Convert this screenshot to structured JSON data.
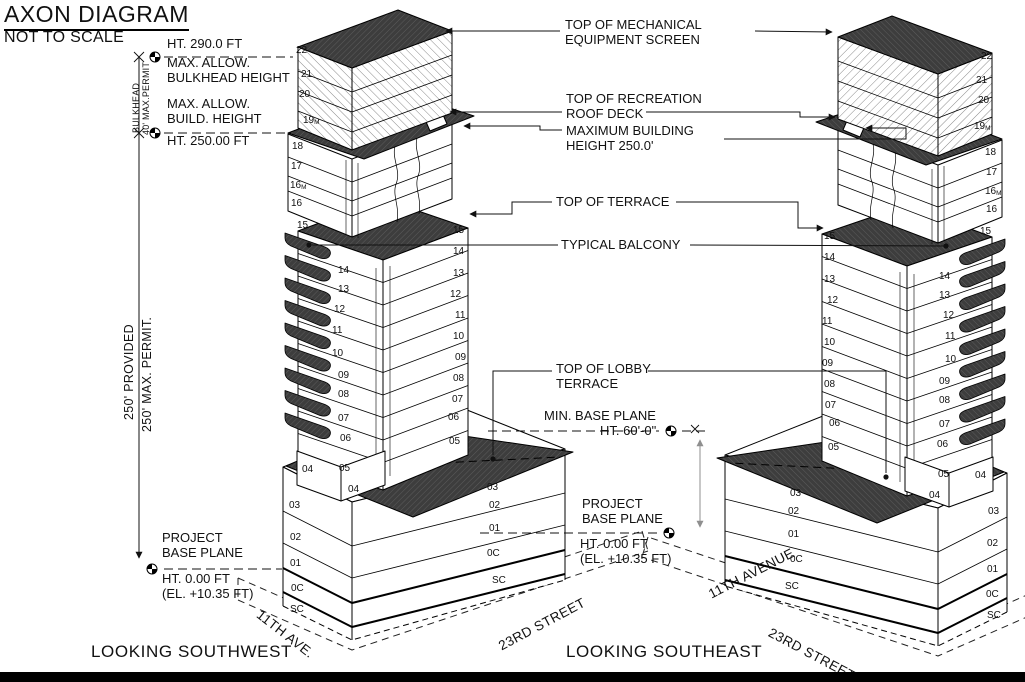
{
  "title": "AXON DIAGRAM",
  "subtitle": "NOT TO SCALE",
  "captions": {
    "southwest": "LOOKING SOUTHWEST",
    "southeast": "LOOKING SOUTHEAST"
  },
  "streets": {
    "ave_left": "11TH AVE.",
    "st_left": "23RD STREET",
    "ave_right": "11TH AVENUE",
    "st_right": "23RD STREET"
  },
  "dims": {
    "bulkhead": "BULKHEAD",
    "bulkhead_permit": "40' MAX.PERMIT",
    "provided": "250' PROVIDED",
    "max_permit": "250' MAX. PERMIT.",
    "ht_290": "HT. 290.0 FT",
    "max_allow_1": "MAX. ALLOW.",
    "bulkhead_height": "BULKHEAD HEIGHT",
    "max_allow_2": "MAX. ALLOW.",
    "build_height": "BUILD. HEIGHT",
    "ht_250": "HT. 250.00 FT"
  },
  "annotations": {
    "mech_1": "TOP OF MECHANICAL",
    "mech_2": "EQUIPMENT SCREEN",
    "rec_1": "TOP OF RECREATION",
    "rec_2": "ROOF DECK",
    "maxb_1": "MAXIMUM BUILDING",
    "maxb_2": "HEIGHT 250.0'",
    "terrace": "TOP OF TERRACE",
    "balcony": "TYPICAL BALCONY",
    "lobby_1": "TOP OF LOBBY",
    "lobby_2": "TERRACE",
    "minbase_1": "MIN. BASE PLANE",
    "minbase_2": "HT. 60'-0\"",
    "pbp_1": "PROJECT",
    "pbp_2": "BASE PLANE",
    "pbp_ht": "HT. 0.00 FT",
    "pbp_el": "(EL. +10.35 FT)",
    "pbp_left_1": "PROJECT",
    "pbp_left_2": "BASE PLANE",
    "pbp_left_ht": "HT. 0.00 FT",
    "pbp_left_el": "(EL. +10.35 FT)"
  },
  "colors": {
    "paper": "#ffffff",
    "ink": "#111111",
    "dark_fill": "#3d3d3d",
    "dim_gray": "#8f8f8f"
  },
  "floor_labels": {
    "left": [
      {
        "t": "22",
        "x": 296,
        "y": 53
      },
      {
        "t": "21",
        "x": 301,
        "y": 77
      },
      {
        "t": "20",
        "x": 299,
        "y": 97
      },
      {
        "t": "19",
        "s": "M",
        "x": 303,
        "y": 123
      },
      {
        "t": "18",
        "x": 292,
        "y": 149
      },
      {
        "t": "17",
        "x": 291,
        "y": 169
      },
      {
        "t": "16",
        "s": "M",
        "x": 290,
        "y": 188
      },
      {
        "t": "16",
        "x": 291,
        "y": 206
      },
      {
        "t": "15",
        "x": 297,
        "y": 228
      },
      {
        "t": "14",
        "x": 338,
        "y": 273
      },
      {
        "t": "13",
        "x": 338,
        "y": 292
      },
      {
        "t": "12",
        "x": 334,
        "y": 312
      },
      {
        "t": "11",
        "x": 332,
        "y": 333
      },
      {
        "t": "10",
        "x": 332,
        "y": 356
      },
      {
        "t": "09",
        "x": 338,
        "y": 378
      },
      {
        "t": "08",
        "x": 338,
        "y": 397
      },
      {
        "t": "07",
        "x": 338,
        "y": 421
      },
      {
        "t": "06",
        "x": 340,
        "y": 441
      },
      {
        "t": "05",
        "x": 339,
        "y": 471
      },
      {
        "t": "04",
        "x": 302,
        "y": 472
      },
      {
        "t": "15",
        "x": 453,
        "y": 233
      },
      {
        "t": "14",
        "x": 453,
        "y": 254
      },
      {
        "t": "13",
        "x": 453,
        "y": 276
      },
      {
        "t": "12",
        "x": 450,
        "y": 297
      },
      {
        "t": "11",
        "x": 455,
        "y": 318
      },
      {
        "t": "10",
        "x": 453,
        "y": 339
      },
      {
        "t": "09",
        "x": 455,
        "y": 360
      },
      {
        "t": "08",
        "x": 453,
        "y": 381
      },
      {
        "t": "07",
        "x": 452,
        "y": 402
      },
      {
        "t": "06",
        "x": 448,
        "y": 420
      },
      {
        "t": "05",
        "x": 449,
        "y": 444
      },
      {
        "t": "04",
        "x": 348,
        "y": 492
      },
      {
        "t": "03",
        "x": 289,
        "y": 508
      },
      {
        "t": "02",
        "x": 290,
        "y": 540
      },
      {
        "t": "01",
        "x": 290,
        "y": 566
      },
      {
        "t": "0C",
        "x": 291,
        "y": 591
      },
      {
        "t": "SC",
        "x": 290,
        "y": 612
      },
      {
        "t": "03",
        "x": 487,
        "y": 490
      },
      {
        "t": "02",
        "x": 489,
        "y": 508
      },
      {
        "t": "01",
        "x": 489,
        "y": 531
      },
      {
        "t": "0C",
        "x": 487,
        "y": 556
      },
      {
        "t": "SC",
        "x": 492,
        "y": 583
      }
    ],
    "right": [
      {
        "t": "22",
        "x": 981,
        "y": 59
      },
      {
        "t": "21",
        "x": 976,
        "y": 83
      },
      {
        "t": "20",
        "x": 978,
        "y": 103
      },
      {
        "t": "19",
        "s": "M",
        "x": 974,
        "y": 129
      },
      {
        "t": "18",
        "x": 985,
        "y": 155
      },
      {
        "t": "17",
        "x": 986,
        "y": 175
      },
      {
        "t": "16",
        "s": "M",
        "x": 985,
        "y": 194
      },
      {
        "t": "16",
        "x": 986,
        "y": 212
      },
      {
        "t": "15",
        "x": 980,
        "y": 234
      },
      {
        "t": "15",
        "x": 824,
        "y": 239
      },
      {
        "t": "14",
        "x": 824,
        "y": 260
      },
      {
        "t": "13",
        "x": 824,
        "y": 282
      },
      {
        "t": "12",
        "x": 827,
        "y": 303
      },
      {
        "t": "11",
        "x": 822,
        "y": 324
      },
      {
        "t": "10",
        "x": 824,
        "y": 345
      },
      {
        "t": "09",
        "x": 822,
        "y": 366
      },
      {
        "t": "08",
        "x": 824,
        "y": 387
      },
      {
        "t": "07",
        "x": 825,
        "y": 408
      },
      {
        "t": "06",
        "x": 829,
        "y": 426
      },
      {
        "t": "05",
        "x": 828,
        "y": 450
      },
      {
        "t": "14",
        "x": 939,
        "y": 279
      },
      {
        "t": "13",
        "x": 939,
        "y": 298
      },
      {
        "t": "12",
        "x": 943,
        "y": 318
      },
      {
        "t": "11",
        "x": 945,
        "y": 339
      },
      {
        "t": "10",
        "x": 945,
        "y": 362
      },
      {
        "t": "09",
        "x": 939,
        "y": 384
      },
      {
        "t": "08",
        "x": 939,
        "y": 403
      },
      {
        "t": "07",
        "x": 939,
        "y": 427
      },
      {
        "t": "06",
        "x": 937,
        "y": 447
      },
      {
        "t": "05",
        "x": 938,
        "y": 477
      },
      {
        "t": "04",
        "x": 975,
        "y": 478
      },
      {
        "t": "04",
        "x": 929,
        "y": 498
      },
      {
        "t": "03",
        "x": 988,
        "y": 514
      },
      {
        "t": "02",
        "x": 987,
        "y": 546
      },
      {
        "t": "01",
        "x": 987,
        "y": 572
      },
      {
        "t": "0C",
        "x": 986,
        "y": 597
      },
      {
        "t": "SC",
        "x": 987,
        "y": 618
      },
      {
        "t": "03",
        "x": 790,
        "y": 496
      },
      {
        "t": "02",
        "x": 788,
        "y": 514
      },
      {
        "t": "01",
        "x": 788,
        "y": 537
      },
      {
        "t": "0C",
        "x": 790,
        "y": 562
      },
      {
        "t": "SC",
        "x": 785,
        "y": 589
      }
    ]
  }
}
